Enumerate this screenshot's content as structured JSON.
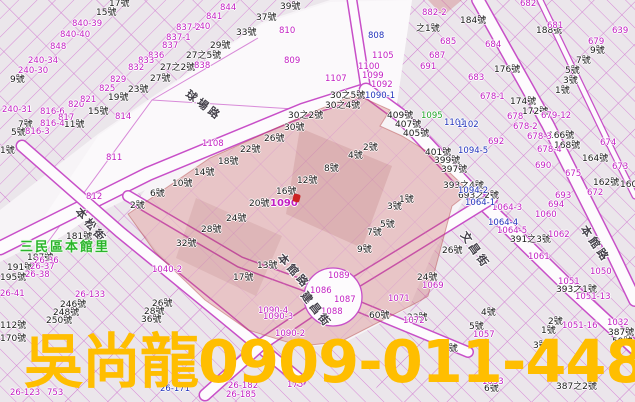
{
  "map": {
    "district_label": "三民區本館里",
    "highlight_lot": "1090",
    "streets": [
      {
        "name": "球場路",
        "x": 192,
        "y": 86,
        "rot": 37
      },
      {
        "name": "本松街",
        "x": 84,
        "y": 204,
        "rot": 50
      },
      {
        "name": "本館路",
        "x": 286,
        "y": 250,
        "rot": 48
      },
      {
        "name": "建昌街",
        "x": 310,
        "y": 288,
        "rot": 52
      },
      {
        "name": "文昌街",
        "x": 470,
        "y": 228,
        "rot": 55
      },
      {
        "name": "本館路",
        "x": 590,
        "y": 222,
        "rot": 55
      }
    ],
    "parcel_labels_black": [
      [
        "17號",
        109,
        0
      ],
      [
        "15號",
        96,
        9
      ],
      [
        "39號",
        280,
        3
      ],
      [
        "37號",
        256,
        14
      ],
      [
        "33號",
        236,
        29
      ],
      [
        "29號",
        210,
        42
      ],
      [
        "27之5號",
        186,
        52
      ],
      [
        "27之2號",
        160,
        64
      ],
      [
        "27號",
        150,
        75
      ],
      [
        "23號",
        128,
        86
      ],
      [
        "19號",
        108,
        94
      ],
      [
        "9號",
        10,
        76
      ],
      [
        "15號",
        88,
        108
      ],
      [
        "11號",
        64,
        121
      ],
      [
        "7號",
        18,
        121
      ],
      [
        "5號",
        11,
        129
      ],
      [
        "1號",
        0,
        147
      ],
      [
        "188號",
        536,
        27
      ],
      [
        "184號",
        460,
        17
      ],
      [
        "之1號",
        416,
        25
      ],
      [
        "176號",
        494,
        66
      ],
      [
        "174號",
        510,
        98
      ],
      [
        "172號",
        522,
        108
      ],
      [
        "166號",
        548,
        132
      ],
      [
        "168號",
        554,
        142
      ],
      [
        "164號",
        582,
        155
      ],
      [
        "162號",
        593,
        179
      ],
      [
        "160",
        620,
        181
      ],
      [
        "9號",
        590,
        47
      ],
      [
        "7號",
        576,
        57
      ],
      [
        "5號",
        565,
        67
      ],
      [
        "3號",
        563,
        77
      ],
      [
        "1號",
        555,
        87
      ],
      [
        "30號",
        284,
        124
      ],
      [
        "26號",
        264,
        135
      ],
      [
        "22號",
        240,
        146
      ],
      [
        "18號",
        218,
        158
      ],
      [
        "14號",
        194,
        169
      ],
      [
        "10號",
        172,
        180
      ],
      [
        "6號",
        150,
        190
      ],
      [
        "12號",
        297,
        177
      ],
      [
        "16號",
        276,
        188
      ],
      [
        "20號",
        249,
        200
      ],
      [
        "24號",
        226,
        215
      ],
      [
        "28號",
        201,
        226
      ],
      [
        "32號",
        176,
        240
      ],
      [
        "30之2號",
        288,
        112
      ],
      [
        "30之4號",
        325,
        102
      ],
      [
        "30之5號",
        330,
        92
      ],
      [
        "409號",
        387,
        112
      ],
      [
        "407號",
        395,
        121
      ],
      [
        "405號",
        403,
        130
      ],
      [
        "401號",
        425,
        149
      ],
      [
        "399號",
        434,
        157
      ],
      [
        "397號",
        441,
        166
      ],
      [
        "2號",
        363,
        144
      ],
      [
        "4號",
        348,
        152
      ],
      [
        "8號",
        324,
        165
      ],
      [
        "1號",
        399,
        196
      ],
      [
        "3號",
        387,
        203
      ],
      [
        "5號",
        380,
        221
      ],
      [
        "7號",
        367,
        229
      ],
      [
        "9號",
        357,
        246
      ],
      [
        "13號",
        257,
        262
      ],
      [
        "17號",
        233,
        274
      ],
      [
        "393之4號",
        443,
        182
      ],
      [
        "26號",
        442,
        247
      ],
      [
        "24號",
        417,
        274
      ],
      [
        "2號",
        130,
        202
      ],
      [
        "181號",
        66,
        233
      ],
      [
        "187號",
        27,
        254
      ],
      [
        "191號",
        7,
        264
      ],
      [
        "195號",
        0,
        274
      ],
      [
        "693之2號",
        458,
        192
      ],
      [
        "391之3號",
        510,
        236
      ],
      [
        "393之1號",
        556,
        286
      ],
      [
        "60號",
        369,
        312
      ],
      [
        "23號",
        407,
        314
      ],
      [
        "4號",
        481,
        309
      ],
      [
        "2號",
        548,
        318
      ],
      [
        "1號",
        541,
        327
      ],
      [
        "5號",
        469,
        323
      ],
      [
        "8號",
        443,
        345
      ],
      [
        "3號",
        533,
        342
      ],
      [
        "387號",
        608,
        329
      ],
      [
        "387之2號",
        556,
        383
      ],
      [
        "6號",
        484,
        385
      ],
      [
        "59號",
        612,
        338
      ],
      [
        "26號",
        152,
        300
      ],
      [
        "28號",
        144,
        308
      ],
      [
        "36號",
        141,
        316
      ],
      [
        "246號",
        60,
        301
      ],
      [
        "248號",
        53,
        309
      ],
      [
        "250號",
        46,
        317
      ],
      [
        "112號",
        0,
        322
      ],
      [
        "170號",
        0,
        335
      ]
    ],
    "lot_numbers_magenta": [
      [
        "840-39",
        72,
        20
      ],
      [
        "840-40",
        60,
        31
      ],
      [
        "848",
        50,
        43
      ],
      [
        "240-34",
        28,
        57
      ],
      [
        "240-30",
        18,
        67
      ],
      [
        "240-31",
        2,
        106
      ],
      [
        "816-6",
        40,
        108
      ],
      [
        "817",
        58,
        114
      ],
      [
        "820",
        68,
        101
      ],
      [
        "821",
        80,
        96
      ],
      [
        "816-4",
        40,
        120
      ],
      [
        "816-3",
        25,
        128
      ],
      [
        "814",
        115,
        113
      ],
      [
        "811",
        106,
        154
      ],
      [
        "812",
        86,
        193
      ],
      [
        "844",
        220,
        4
      ],
      [
        "841",
        206,
        13
      ],
      [
        "840",
        194,
        23
      ],
      [
        "837-2",
        176,
        24
      ],
      [
        "837-1",
        166,
        34
      ],
      [
        "837",
        162,
        42
      ],
      [
        "836",
        148,
        52
      ],
      [
        "833",
        138,
        57
      ],
      [
        "832",
        128,
        64
      ],
      [
        "838",
        194,
        62
      ],
      [
        "829",
        110,
        76
      ],
      [
        "825",
        99,
        85
      ],
      [
        "810",
        279,
        27
      ],
      [
        "809",
        284,
        57
      ],
      [
        "1105",
        372,
        52
      ],
      [
        "1100",
        358,
        63
      ],
      [
        "1099",
        362,
        72
      ],
      [
        "1107",
        325,
        75
      ],
      [
        "1092",
        371,
        81
      ],
      [
        "1108",
        202,
        140
      ],
      [
        "1090",
        270,
        199,
        1
      ],
      [
        "882-2",
        422,
        9
      ],
      [
        "682",
        520,
        0
      ],
      [
        "681",
        547,
        22
      ],
      [
        "684",
        485,
        41
      ],
      [
        "685",
        440,
        38
      ],
      [
        "683",
        468,
        74
      ],
      [
        "687",
        429,
        52
      ],
      [
        "691",
        420,
        63
      ],
      [
        "639",
        612,
        27
      ],
      [
        "679",
        588,
        38
      ],
      [
        "678-1",
        480,
        93
      ],
      [
        "679-12",
        541,
        112
      ],
      [
        "678",
        507,
        113
      ],
      [
        "678-2",
        513,
        123
      ],
      [
        "678-3",
        527,
        133
      ],
      [
        "678-4",
        537,
        146
      ],
      [
        "692",
        488,
        138
      ],
      [
        "690",
        535,
        162
      ],
      [
        "675",
        565,
        170
      ],
      [
        "674",
        600,
        139
      ],
      [
        "673",
        612,
        163
      ],
      [
        "672",
        587,
        189
      ],
      [
        "693",
        555,
        192
      ],
      [
        "694",
        548,
        201
      ],
      [
        "1050",
        590,
        268
      ],
      [
        "1051",
        558,
        278
      ],
      [
        "1051-13",
        575,
        293
      ],
      [
        "1051-16",
        562,
        322
      ],
      [
        "1032",
        607,
        319
      ],
      [
        "1061",
        528,
        253
      ],
      [
        "1062",
        548,
        231
      ],
      [
        "1060",
        535,
        211
      ],
      [
        "1064-3",
        492,
        204
      ],
      [
        "1064-5",
        497,
        227
      ],
      [
        "1069",
        422,
        282
      ],
      [
        "1071",
        388,
        295
      ],
      [
        "1072",
        403,
        317
      ],
      [
        "1090-4",
        258,
        307
      ],
      [
        "1090-3",
        263,
        313
      ],
      [
        "1090-2",
        275,
        330
      ],
      [
        "1089",
        328,
        272
      ],
      [
        "1086",
        310,
        287
      ],
      [
        "1087",
        334,
        296
      ],
      [
        "1088",
        321,
        308
      ],
      [
        "1040-2",
        152,
        266
      ],
      [
        "26-36",
        34,
        257
      ],
      [
        "26-37",
        30,
        263
      ],
      [
        "26-38",
        25,
        271
      ],
      [
        "26-41",
        0,
        290
      ],
      [
        "26-133",
        75,
        291
      ],
      [
        "26-123",
        10,
        389
      ],
      [
        "26-182",
        228,
        382
      ],
      [
        "26-185",
        226,
        391
      ],
      [
        "753",
        47,
        389
      ],
      [
        "1057",
        473,
        331
      ],
      [
        "1053",
        482,
        378
      ],
      [
        "175",
        287,
        381
      ]
    ],
    "lot_numbers_blue": [
      [
        "808",
        368,
        32
      ],
      [
        "1090-1",
        365,
        92
      ],
      [
        "1101",
        444,
        119
      ],
      [
        "1102",
        457,
        121
      ],
      [
        "1094-5",
        458,
        147
      ],
      [
        "1094-2",
        458,
        187
      ],
      [
        "1064-1",
        465,
        199
      ],
      [
        "1064-4",
        488,
        219
      ],
      [
        "26-171",
        160,
        385
      ]
    ],
    "lot_numbers_green": [
      [
        "1095",
        421,
        112
      ]
    ]
  },
  "watermark": {
    "text": "吳尚龍0909-011-448",
    "color": "#FFBE00"
  },
  "colors": {
    "parcel_line": "#D88AD8",
    "road_edge": "#C84FC8",
    "parcel_fill": "#EBE6EB",
    "highlight_fill": "#E9B9B9",
    "black_label": "#1A1A1A",
    "magenta_label": "#C21FC2",
    "blue_label": "#2233BB",
    "green_label": "#22A52A",
    "district_green": "#2AB42A",
    "marker_red": "#CC2222",
    "street_text": "#44404A"
  }
}
